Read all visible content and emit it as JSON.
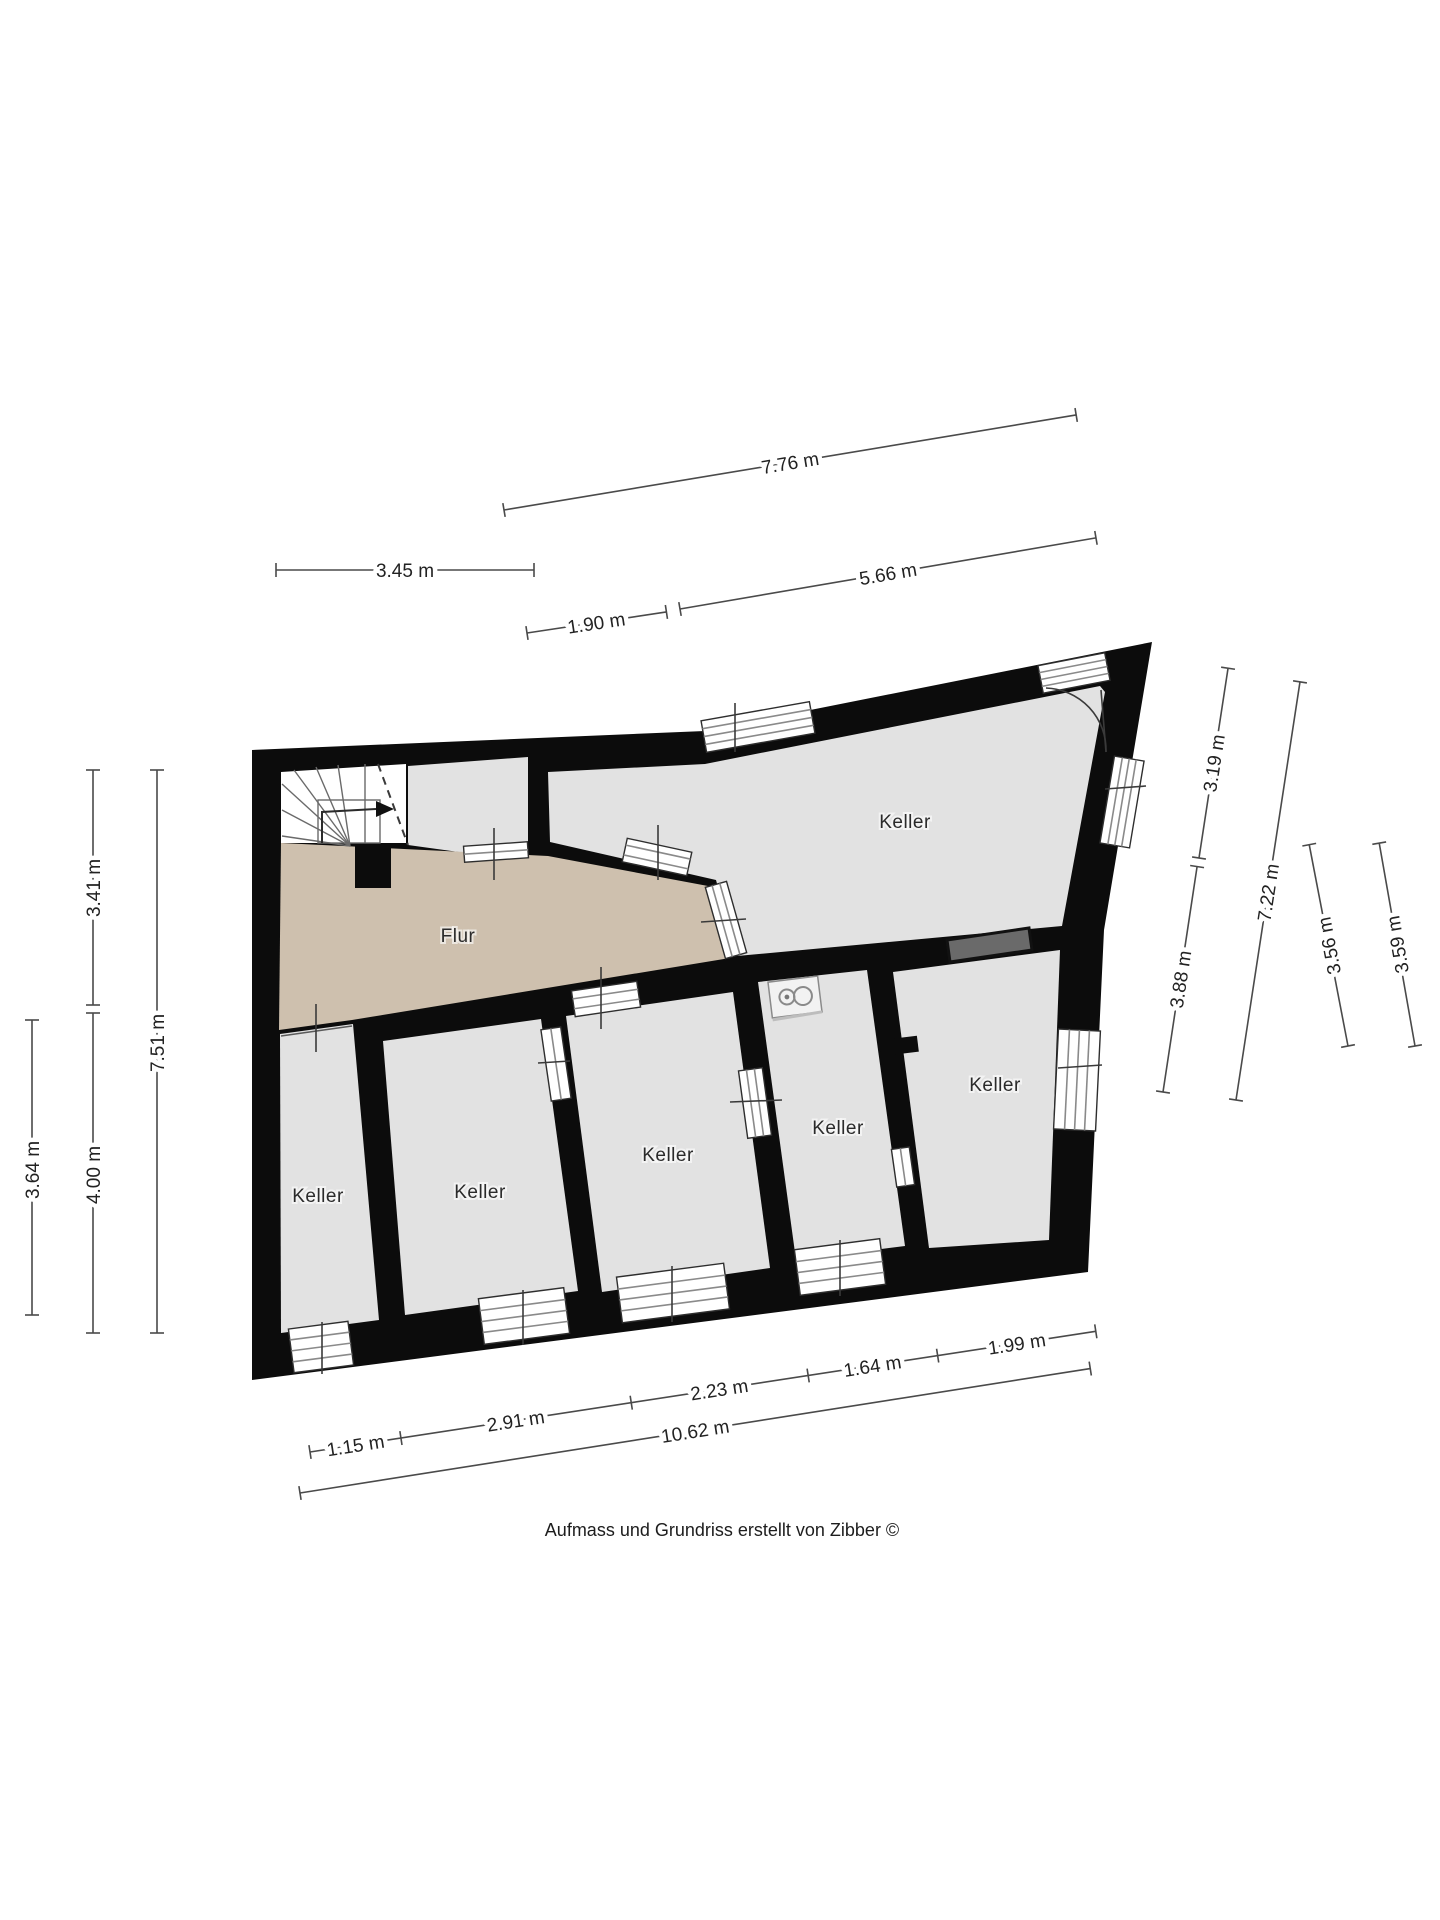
{
  "plan": {
    "caption": "Aufmass und Grundriss erstellt von Zibber ©",
    "colors": {
      "wall": "#0c0c0c",
      "room": "#e2e2e2",
      "hallway": "#cec0ae",
      "stairwell": "#ffffff",
      "niche": "#6a6a6a",
      "paper": "#ffffff"
    },
    "rooms": [
      {
        "id": "flur",
        "label": "Flur"
      },
      {
        "id": "keller-main",
        "label": "Keller"
      },
      {
        "id": "keller-right",
        "label": "Keller"
      },
      {
        "id": "keller-boiler",
        "label": "Keller"
      },
      {
        "id": "keller-center",
        "label": "Keller"
      },
      {
        "id": "keller-second",
        "label": "Keller"
      },
      {
        "id": "keller-left",
        "label": "Keller"
      }
    ],
    "icons": [
      "stairs-icon",
      "door-swing-icon",
      "washing-machine-icon",
      "wall-niche"
    ]
  },
  "dims": {
    "top": [
      "7.76 m",
      "3.45 m",
      "5.66 m",
      "1.90 m"
    ],
    "left": [
      "3.41 m",
      "7.51 m",
      "3.64 m",
      "4.00 m"
    ],
    "right": [
      "3.19 m",
      "3.88 m",
      "7.22 m",
      "3.56 m",
      "3.59 m"
    ],
    "bottom": [
      "1.15 m",
      "2.91 m",
      "2.23 m",
      "1.64 m",
      "1.99 m"
    ],
    "bottom_total": "10.62 m"
  }
}
